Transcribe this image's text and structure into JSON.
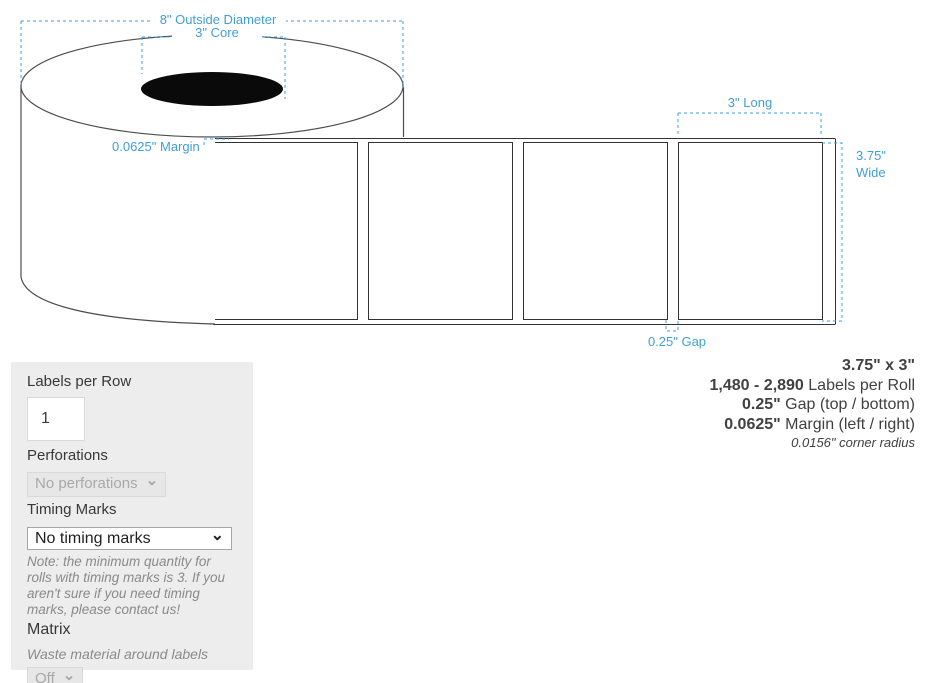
{
  "colors": {
    "accent_blue": "#3f9fd8",
    "diagram_line": "#4d4d4d",
    "panel_bg": "#ededed"
  },
  "diagram": {
    "outside_diameter_label": "8\" Outside Diameter",
    "core_label": "3\" Core",
    "margin_label": "0.0625\" Margin",
    "long_label": "3\" Long",
    "wide_label_line1": "3.75\"",
    "wide_label_line2": "Wide",
    "gap_label": "0.25\" Gap"
  },
  "form": {
    "labels_per_row": {
      "label": "Labels per Row",
      "value": "1"
    },
    "perforations": {
      "label": "Perforations",
      "selected": "No perforations"
    },
    "timing_marks": {
      "label": "Timing Marks",
      "selected": "No timing marks",
      "note": "Note: the minimum quantity for rolls with timing marks is 3. If you aren't sure if you need timing marks, please contact us!"
    },
    "matrix": {
      "label": "Matrix",
      "description": "Waste material around labels",
      "selected": "Off"
    }
  },
  "specs": {
    "size": "3.75\" x 3\"",
    "rows": [
      {
        "strong": "1,480 - 2,890",
        "rest": " Labels per Roll"
      },
      {
        "strong": "0.25\"",
        "rest": " Gap (top / bottom)"
      },
      {
        "strong": "0.0625\"",
        "rest": " Margin (left / right)"
      }
    ],
    "corner_radius": "0.0156\" corner radius"
  },
  "icons": {
    "chevron_down": "⌄"
  }
}
